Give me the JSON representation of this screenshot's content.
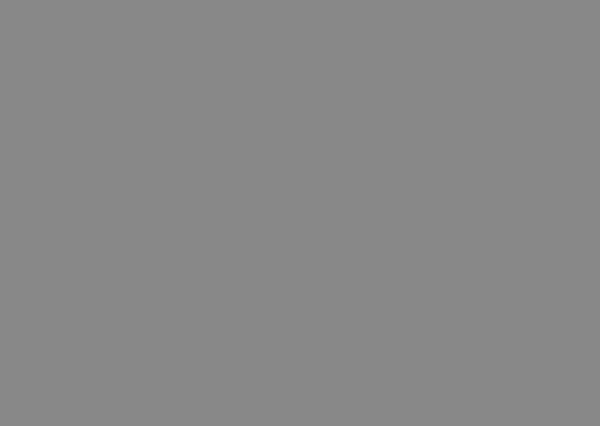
{
  "title": {
    "prefix": "—",
    "zh": "北京城市全图",
    "en": "Beijing city full map"
  },
  "annotation": {
    "distance_label": "19km",
    "distance_label_pos": {
      "x": 196,
      "y": 227,
      "size": 12
    },
    "line": {
      "x1": 34,
      "y1": 230.5,
      "x2": 368,
      "y2": 230.5,
      "w": 2.6
    },
    "west_box": {
      "x": 3,
      "y": 190,
      "w": 55,
      "h": 72,
      "rx": 10,
      "dash": "8 5",
      "sw": 3
    },
    "center_box": {
      "x": 337,
      "y": 185,
      "w": 31,
      "h": 46,
      "rx": 6,
      "dash": "6 4.5",
      "sw": 2.8
    },
    "blue_marker": {
      "x": 336,
      "y": 172,
      "w": 9,
      "h": 11
    }
  },
  "colors": {
    "background": "#F6F2C0",
    "urban_base": "#A3C982",
    "block_pale": "#F0ECC0",
    "block_dark": "#7DB261",
    "park": "#74AC58",
    "park_dark": "#5E9A4B",
    "hills": "#B9CB40",
    "water": "#53AEDE",
    "road_yellow": "#F3C81F",
    "road_tick": "#D2691E",
    "road_minor": "#D9D2A6",
    "street_white": "#FFFFFF",
    "railway_grey": "#8C8C8C",
    "annotation_red": "#E02518",
    "title_red": "#E3492F",
    "marker_blue": "#2E6FD8",
    "imperial_yellow": "#EEE27E",
    "speck_colors": [
      "#C0392B",
      "#D774A8",
      "#4A72C4",
      "#606060",
      "#8A6FC8"
    ]
  },
  "map": {
    "width": 600,
    "height": 426,
    "urban_shapes": [
      [
        128,
        52,
        392,
        340,
        55
      ],
      [
        58,
        196,
        95,
        80,
        22
      ],
      [
        490,
        160,
        62,
        142,
        24
      ],
      [
        230,
        24,
        200,
        70,
        24
      ],
      [
        168,
        95,
        60,
        95,
        20
      ],
      [
        445,
        55,
        80,
        70,
        24
      ],
      [
        175,
        345,
        230,
        62,
        24
      ]
    ],
    "gen": {
      "pale_blocks": 46,
      "dark_blocks": 34,
      "specks": 150,
      "grid_step": 8,
      "seed_pale": 7,
      "seed_dark": 13,
      "seed_speck": 29
    },
    "hills": [
      [
        24,
        106,
        38,
        52,
        18
      ],
      [
        122,
        18,
        44,
        44,
        16
      ],
      [
        146,
        52,
        42,
        44,
        17
      ],
      [
        197,
        26,
        36,
        28,
        12
      ],
      [
        92,
        5,
        22,
        14,
        7
      ],
      [
        0,
        126,
        14,
        24,
        7
      ],
      [
        94,
        390,
        44,
        36,
        16
      ],
      [
        366,
        282,
        30,
        22,
        8
      ]
    ],
    "suburb_greens": [
      [
        30,
        58,
        16,
        11,
        4
      ],
      [
        58,
        88,
        14,
        11,
        4
      ],
      [
        0,
        56,
        12,
        10,
        4
      ],
      [
        84,
        92,
        12,
        9,
        3
      ],
      [
        60,
        160,
        18,
        12,
        4
      ],
      [
        86,
        176,
        24,
        15,
        5
      ],
      [
        0,
        160,
        12,
        14,
        4
      ],
      [
        104,
        126,
        12,
        9,
        3
      ],
      [
        240,
        6,
        16,
        10,
        3
      ],
      [
        262,
        52,
        18,
        12,
        4
      ],
      [
        298,
        24,
        14,
        9,
        3
      ],
      [
        330,
        6,
        24,
        10,
        3
      ],
      [
        372,
        14,
        20,
        12,
        4
      ],
      [
        412,
        20,
        28,
        16,
        5
      ],
      [
        452,
        6,
        14,
        9,
        3
      ],
      [
        498,
        34,
        24,
        14,
        4
      ],
      [
        540,
        26,
        14,
        10,
        3
      ],
      [
        572,
        42,
        16,
        12,
        4
      ],
      [
        470,
        44,
        16,
        10,
        3
      ],
      [
        558,
        84,
        28,
        30,
        8
      ],
      [
        584,
        136,
        16,
        46,
        6
      ],
      [
        542,
        132,
        24,
        44,
        7
      ],
      [
        552,
        206,
        34,
        28,
        8
      ],
      [
        578,
        256,
        22,
        18,
        6
      ],
      [
        544,
        306,
        22,
        14,
        5
      ],
      [
        518,
        352,
        18,
        12,
        4
      ],
      [
        556,
        368,
        26,
        16,
        5
      ],
      [
        468,
        384,
        32,
        18,
        6
      ],
      [
        418,
        404,
        26,
        13,
        4
      ],
      [
        348,
        394,
        32,
        16,
        5
      ],
      [
        286,
        396,
        36,
        18,
        6
      ],
      [
        232,
        406,
        28,
        12,
        4
      ],
      [
        176,
        390,
        30,
        16,
        5
      ],
      [
        120,
        334,
        16,
        26,
        6
      ],
      [
        58,
        298,
        14,
        20,
        5
      ],
      [
        0,
        290,
        20,
        34,
        7
      ],
      [
        0,
        336,
        14,
        36,
        6
      ],
      [
        28,
        366,
        14,
        12,
        4
      ],
      [
        140,
        298,
        20,
        14,
        5
      ]
    ],
    "parks": [
      [
        340,
        189,
        25,
        38,
        3,
        "p"
      ],
      [
        350,
        277,
        44,
        35,
        10,
        "d"
      ],
      [
        360,
        285,
        22,
        19,
        9,
        "p"
      ],
      [
        452,
        142,
        34,
        34,
        10,
        "p"
      ],
      [
        330,
        34,
        44,
        36,
        12,
        "p"
      ],
      [
        342,
        72,
        18,
        44,
        5,
        "d"
      ],
      [
        360,
        126,
        12,
        13,
        3,
        "p"
      ],
      [
        427,
        216,
        13,
        12,
        3,
        "p"
      ],
      [
        390,
        292,
        18,
        11,
        3,
        "p"
      ],
      [
        318,
        306,
        18,
        11,
        3,
        "p"
      ],
      [
        322,
        172,
        16,
        15,
        4,
        "p"
      ],
      [
        344,
        177,
        13,
        8,
        2,
        "d"
      ],
      [
        258,
        158,
        28,
        14,
        4,
        "p"
      ],
      [
        238,
        174,
        20,
        11,
        3,
        "p"
      ],
      [
        214,
        196,
        38,
        24,
        6,
        "p"
      ],
      [
        2,
        192,
        56,
        64,
        14,
        "p"
      ],
      [
        50,
        206,
        30,
        26,
        8,
        "d"
      ],
      [
        26,
        248,
        34,
        28,
        10,
        "p"
      ],
      [
        60,
        238,
        24,
        18,
        6,
        "p"
      ],
      [
        150,
        208,
        20,
        13,
        4,
        "p"
      ],
      [
        300,
        118,
        14,
        10,
        3,
        "p"
      ],
      [
        218,
        58,
        34,
        24,
        6,
        "p"
      ],
      [
        196,
        76,
        22,
        16,
        5,
        "p"
      ],
      [
        420,
        118,
        18,
        13,
        4,
        "p"
      ],
      [
        386,
        94,
        15,
        10,
        3,
        "p"
      ],
      [
        268,
        330,
        16,
        11,
        3,
        "p"
      ],
      [
        230,
        300,
        14,
        10,
        3,
        "p"
      ],
      [
        470,
        240,
        16,
        12,
        3,
        "p"
      ],
      [
        500,
        200,
        18,
        14,
        4,
        "p"
      ],
      [
        178,
        128,
        18,
        12,
        4,
        "p"
      ],
      [
        168,
        180,
        16,
        10,
        3,
        "p"
      ],
      [
        330,
        336,
        30,
        20,
        5,
        "d"
      ],
      [
        370,
        344,
        26,
        16,
        4,
        "d"
      ],
      [
        404,
        330,
        20,
        14,
        4,
        "p"
      ],
      [
        300,
        70,
        18,
        12,
        4,
        "p"
      ],
      [
        398,
        60,
        16,
        11,
        3,
        "p"
      ]
    ],
    "imperial_patch": [
      348,
      192,
      10,
      8,
      2
    ],
    "rural_roads": [
      "M 0,96 L 70,102 L 128,110",
      "M 44,0 L 58,56 L 56,108",
      "M 60,426 L 70,380 L 62,332",
      "M 140,426 L 150,382 L 162,352",
      "M 558,112 L 600,108",
      "M 540,0 L 530,40 L 536,80",
      "M 518,338 L 560,358 L 600,364",
      "M 478,426 L 500,400 L 540,396",
      "M 0,312 L 40,318 L 80,330",
      "M 578,180 L 600,184",
      "M 96,40 L 132,62",
      "M 0,226 L 24,228",
      "M 566,426 L 572,390 L 570,348"
    ],
    "railways": [
      "M 28,246 C 120,252 190,258 262,264 L 332,270",
      "M 430,300 C 470,330 508,372 538,426",
      "M 302,70 C 320,40 334,20 344,0"
    ],
    "rivers": [
      {
        "d": "M 0,253 C 26,259 46,265 58,277 C 74,294 84,312 96,332 C 108,352 112,363 110,379 C 109,392 114,410 123,426",
        "w": 6
      },
      {
        "d": "M 150,92 C 162,114 178,138 200,166 C 214,182 228,196 232,204",
        "w": 2.5
      },
      {
        "d": "M 478,6 C 489,38 504,58 524,67 C 544,75 558,69 567,57",
        "w": 2.5
      },
      {
        "d": "M 430,247 C 480,250 530,244 600,240",
        "w": 2
      }
    ],
    "lakes": [
      [
        166,
        74,
        13,
        12
      ],
      [
        159,
        88,
        6,
        5
      ],
      [
        214,
        39,
        5,
        4
      ],
      [
        320,
        155,
        5,
        4
      ],
      [
        328,
        164,
        5,
        4
      ],
      [
        336,
        173,
        6,
        5
      ],
      [
        330,
        183,
        6,
        5
      ],
      [
        233,
        211,
        13,
        6
      ],
      [
        227,
        259,
        5,
        3
      ],
      [
        108,
        396,
        22,
        13
      ],
      [
        129,
        409,
        10,
        7
      ],
      [
        556,
        71,
        9,
        7
      ],
      [
        566,
        60,
        5,
        4
      ],
      [
        398,
        297,
        6,
        3
      ],
      [
        426,
        392,
        4,
        3
      ],
      [
        540,
        388,
        3,
        2.5
      ],
      [
        552,
        396,
        3,
        2.5
      ],
      [
        561,
        389,
        2.5,
        2
      ],
      [
        295,
        382,
        6,
        4
      ],
      [
        318,
        399,
        7,
        5
      ],
      [
        325,
        411,
        5,
        4
      ],
      [
        474,
        158,
        6,
        8
      ]
    ],
    "ring_roads": [
      [
        296,
        145,
        138,
        142,
        16
      ],
      [
        244,
        110,
        209,
        223,
        26
      ],
      [
        217,
        78,
        283,
        300,
        36
      ],
      [
        172,
        21,
        351,
        384,
        56
      ]
    ],
    "radial_roads": [
      "M 60,230.5 L 600,230.5",
      "M 85,181 L 560,181",
      "M 96,303 L 600,304",
      "M 452,212 L 600,210",
      "M 280,252 L 560,253",
      "M 327,100 L 327,400",
      "M 353,18 L 353,82",
      "M 373,60 L 373,420",
      "M 279,82 L 279,402",
      "M 410,58 L 410,426",
      "M 570,252 L 570,348",
      "M 452,130 C 480,100 520,50 560,8",
      "M 276,0 C 290,24 305,48 318,72 L 330,96",
      "M 484,282 C 500,320 518,380 534,426",
      "M 200,324 C 150,330 104,332 88,348 C 72,368 94,398 104,426"
    ]
  }
}
